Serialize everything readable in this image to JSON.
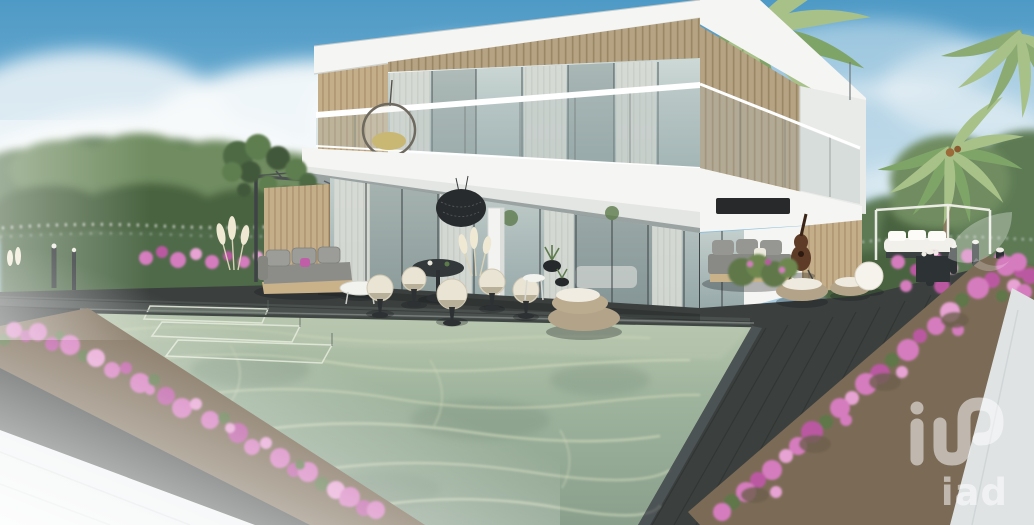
{
  "scene": {
    "type": "3d-architectural-rendering",
    "subject": "Modern two-storey white villa with wood-slat cladding, glass walls, covered terrace with outdoor lounge furniture, dark timber deck, swimming pool with steps, pink bougainvillea beds, hedges and palm trees under a blue sky with clouds",
    "watermark": {
      "text": "iad",
      "symbol": "iad-monogram-and-swoosh"
    }
  },
  "palette": {
    "sky_top": "#4e9ac6",
    "sky_mid": "#8fc0dc",
    "sky_low": "#d8e9f1",
    "cloud_white": "#f7fafb",
    "foliage": "#5d7a54",
    "foliage_dark": "#49643f",
    "foliage_light": "#6f8c60",
    "wall_white": "#f5f5f3",
    "wall_shade": "#e9ebe8",
    "slab_gray": "#9aa3a2",
    "wood": "#c4ae8a",
    "wood_dark": "#a58c66",
    "soffit": "#b5a384",
    "glass_hi": "#c6d3d0",
    "glass_lo": "#93a5a6",
    "curtain": "#d8dbd5",
    "frame_dark": "#3f4447",
    "beam": "#4c5052",
    "deck": "#3b403f",
    "deck_line": "#2c302f",
    "pool_far": "#b7c6ad",
    "pool_mid": "#9fb49d",
    "pool_deep": "#8aa08c",
    "caustic": "#cfd8bc",
    "coping": "#888f8b",
    "flower_pink": "#d57cbe",
    "flower_deep": "#bb58a2",
    "flower_light": "#e7a3d3",
    "leaf_green": "#5f7748",
    "soil": "#7b6b56",
    "pampas": "#efe9d4",
    "pavement": "#eceff0",
    "path_gray": "#dfe3e4",
    "cream": "#eae4d4",
    "sofa_gray": "#8c8d89",
    "wicker": "#b3a489",
    "guitar_brown": "#5e3b26",
    "lamp_white": "#f5f3ec",
    "watermark_white": "#ffffff"
  }
}
